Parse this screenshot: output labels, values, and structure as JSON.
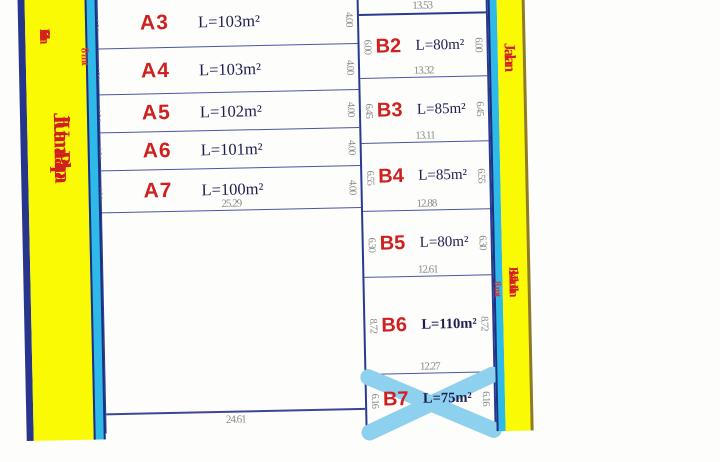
{
  "roads": {
    "left": {
      "secondary_label": "Fisik Jalan",
      "primary_label": "Jln Utama Palapa",
      "width_note": "8 mt"
    },
    "right": {
      "top_label": "Jalan",
      "bottom_label": "Fisik Jalan  Jalan",
      "width_note": "8 mt"
    }
  },
  "block_a": {
    "plots": [
      {
        "id": "A3",
        "area": "L=103m²",
        "left_dim": "4.01",
        "right_dim": "4.00"
      },
      {
        "id": "A4",
        "area": "L=103m²",
        "left_dim": "4.01",
        "right_dim": "4.00"
      },
      {
        "id": "A5",
        "area": "L=102m²",
        "left_dim": "4.01",
        "right_dim": "4.00"
      },
      {
        "id": "A6",
        "area": "L=101m²",
        "left_dim": "4.01",
        "right_dim": "4.00"
      },
      {
        "id": "A7",
        "area": "L=100m²",
        "left_dim": "4.01",
        "right_dim": "4.00",
        "bottom_dim": "25.29"
      }
    ],
    "unlabeled_plot_bottom_dim": "24.61"
  },
  "block_b": {
    "top_dim": "13.53",
    "plots": [
      {
        "id": "B2",
        "area": "L=80m²",
        "left_dim": "6.00",
        "right_dim": "6.00",
        "bottom_dim": "13.32"
      },
      {
        "id": "B3",
        "area": "L=85m²",
        "left_dim": "6.45",
        "right_dim": "6.45",
        "bottom_dim": "13.11"
      },
      {
        "id": "B4",
        "area": "L=85m²",
        "left_dim": "6.55",
        "right_dim": "6.55",
        "bottom_dim": "12.88"
      },
      {
        "id": "B5",
        "area": "L=80m²",
        "left_dim": "6.30",
        "right_dim": "6.30",
        "bottom_dim": "12.61"
      },
      {
        "id": "B6",
        "area": "L=110m²",
        "left_dim": "8.72",
        "right_dim": "8.72",
        "bottom_dim": "12.27"
      },
      {
        "id": "B7",
        "area": "L=75m²",
        "left_dim": "6.16",
        "right_dim": "6.16",
        "status": "sold-cross"
      }
    ]
  },
  "colors": {
    "road_yellow": "#fafa04",
    "road_cyan": "#2fb9e9",
    "border_navy": "#2a3a92",
    "plot_id_red": "#cf2020",
    "road_text_red": "#d42222",
    "area_navy": "#1d1d52",
    "dim_gray": "#8b8b8b",
    "sold_cross_blue": "#8ed1ef"
  }
}
